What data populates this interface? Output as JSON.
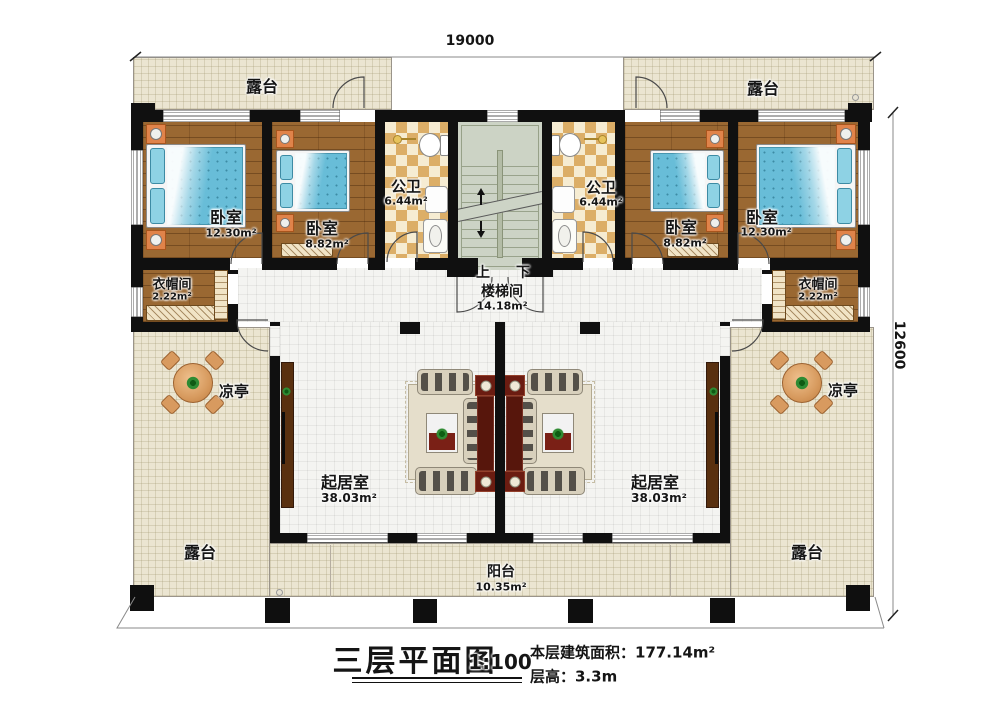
{
  "dimensions": {
    "top": "19000",
    "right": "12600"
  },
  "rooms": {
    "terrace_top_left": {
      "name": "露台"
    },
    "terrace_top_right": {
      "name": "露台"
    },
    "bedroom_left_large": {
      "name": "卧室",
      "area": "12.30m²"
    },
    "bedroom_left_small": {
      "name": "卧室",
      "area": "8.82m²"
    },
    "bathroom_left": {
      "name": "公卫",
      "area": "6.44m²"
    },
    "stairwell": {
      "name": "楼梯间",
      "area": "14.18m²",
      "up": "上",
      "down": "下"
    },
    "bathroom_right": {
      "name": "公卫",
      "area": "6.44m²"
    },
    "bedroom_right_small": {
      "name": "卧室",
      "area": "8.82m²"
    },
    "bedroom_right_large": {
      "name": "卧室",
      "area": "12.30m²"
    },
    "cloakroom_left": {
      "name": "衣帽间",
      "area": "2.22m²"
    },
    "cloakroom_right": {
      "name": "衣帽间",
      "area": "2.22m²"
    },
    "living_left": {
      "name": "起居室",
      "area": "38.03m²"
    },
    "living_right": {
      "name": "起居室",
      "area": "38.03m²"
    },
    "pavilion_left": {
      "name": "凉亭"
    },
    "pavilion_right": {
      "name": "凉亭"
    },
    "terrace_bottom_left": {
      "name": "露台"
    },
    "terrace_bottom_right": {
      "name": "露台"
    },
    "balcony": {
      "name": "阳台",
      "area": "10.35m²"
    }
  },
  "title_block": {
    "title": "三层平面图",
    "scale": "1:100",
    "floor_area": "本层建筑面积：177.14m²",
    "floor_height": "层高：3.3m"
  },
  "colors": {
    "wall": "#101010",
    "wood_floor": "#9a6832",
    "bed_blue": "#68bdd8",
    "bath_checker": "#dcae67",
    "terrace": "#ebe5d1",
    "stair": "#ccd3c5",
    "accent_red": "#6b1c11",
    "cabinet_brown": "#59300f"
  }
}
